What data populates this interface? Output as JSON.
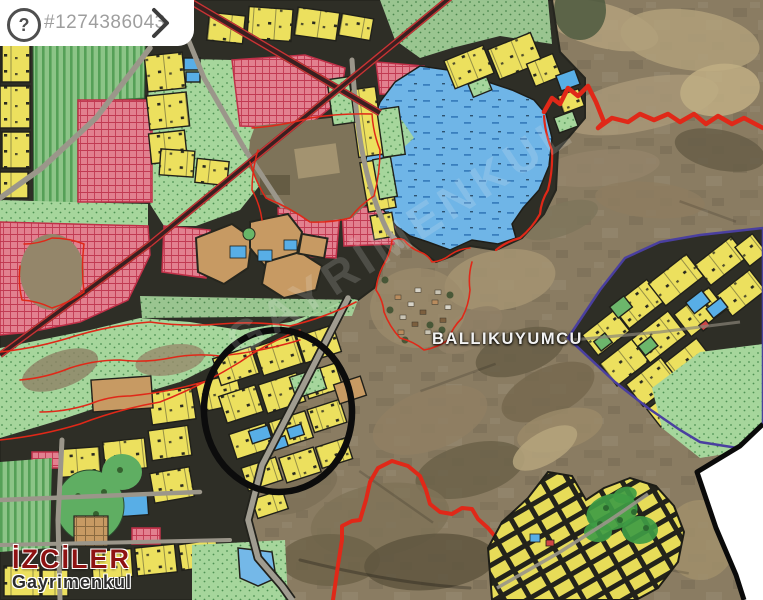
{
  "listing_badge": {
    "help_icon_label": "?",
    "listing_id": "#1274386043",
    "next_icon": "chevron-right"
  },
  "map_labels": {
    "place_name": "BALLIKUYUMCU",
    "watermark": "GAYRİMENKUL"
  },
  "agency_logo": {
    "name": "İZCİLER",
    "subtitle": "Gayrimenkul"
  },
  "legend_colors": {
    "residential_parcel_yellow": "#ece05e",
    "agriculture_striped_green": "#8cc487",
    "pasture_dotted_green": "#a6d69c",
    "special_zone_pink": "#e2808f",
    "reserve_blue": "#6fb5e7",
    "urban_fabric_brown": "#c79a63",
    "plan_street_dark": "#2e2e26",
    "satellite_terrain": "#8a7c62",
    "boundary_red": "#e02818",
    "boundary_purple": "#4a3f9f",
    "railway_corridor": "#3a2020",
    "annotation_ellipse_black": "#0c0c0c",
    "corner_cut_white": "#ffffff"
  }
}
